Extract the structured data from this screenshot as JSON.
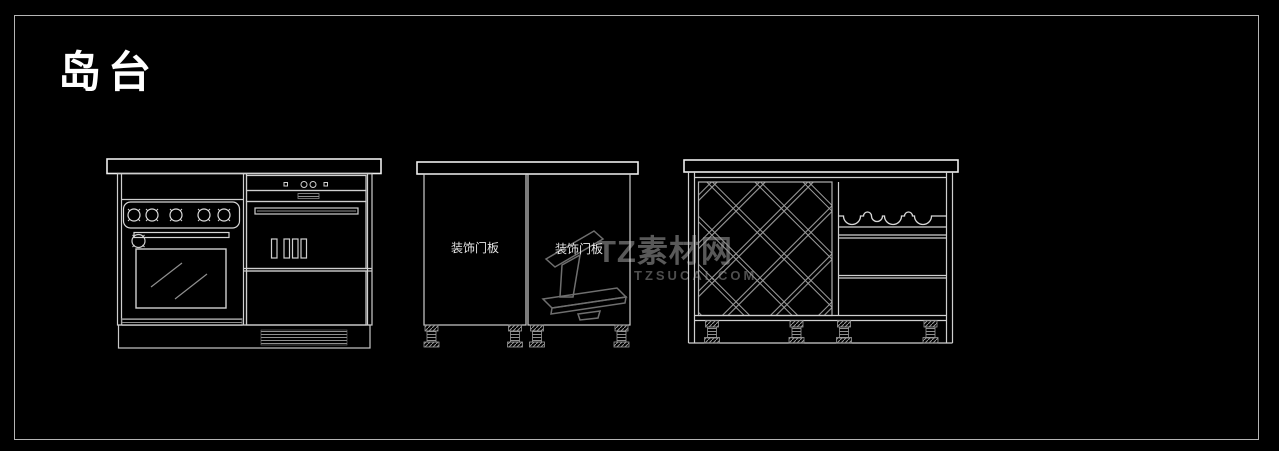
{
  "title": "岛台",
  "watermark": {
    "brand": "TZ素材网",
    "url": "TZSUCAI.COM",
    "logo": "numeral-1-logo",
    "color": "#595959"
  },
  "cabinets": {
    "left": {
      "description": "base cabinet with cooktop knob panel, built-in oven, appliance door and drawer, vented plinth",
      "components": [
        "cooktop-knob-panel",
        "oven-door",
        "oven-window",
        "appliance-control-strip",
        "appliance-handle",
        "drawer-front",
        "plinth-vent"
      ]
    },
    "middle": {
      "description": "two-door base cabinet on adjustable feet",
      "door_labels": [
        "装饰门板",
        "装饰门板"
      ]
    },
    "right": {
      "description": "island unit with diamond wine lattice, bottle shelf and open shelves on adjustable feet",
      "components": [
        "wine-lattice",
        "bottle-wave-shelf",
        "open-shelf",
        "adjustable-feet"
      ]
    }
  },
  "colors": {
    "background": "#000000",
    "border": "#b5b5b5",
    "line": "#cfcfcf",
    "bright_line": "#eeeeee",
    "dim_line": "#9a9a9a",
    "title": "#ffffff",
    "label": "#e6e6e6",
    "watermark": "#595959"
  }
}
